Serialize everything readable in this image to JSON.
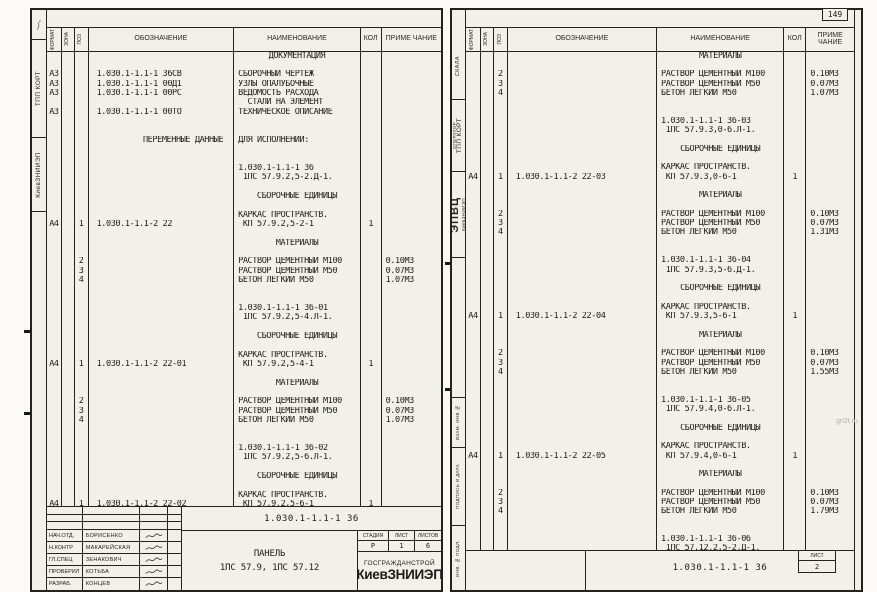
{
  "page_meta": {
    "page_number": "149",
    "watermark": "gn2t.ru"
  },
  "columns": {
    "format": "ФОРМАТ",
    "zone": "ЗОНА",
    "poz": "ПОЗ",
    "oboznachenie": "ОБОЗНАЧЕНИЕ",
    "naimenovanie": "НАИМЕНОВАНИЕ",
    "kol": "КОЛ",
    "primechanie": "ПРИМЕ ЧАНИЕ"
  },
  "left_page": {
    "margin": {
      "dept": "ТПП КОРТ",
      "org": "КиевЗНИИЭП"
    },
    "rows": [
      {
        "n": "ДОКУМЕНТАЦИЯ",
        "c": true
      },
      {},
      {
        "f": "А3",
        "o": "1.030.1-1.1-1 36СВ",
        "n": "СБОРОЧНЫЙ ЧЕРТЕЖ"
      },
      {
        "f": "А3",
        "o": "1.030.1-1.1-1 00Д1",
        "n": "УЗЛЫ ОПАЛУБОЧНЫЕ"
      },
      {
        "f": "А3",
        "o": "1.030.1-1.1-1 00РС",
        "n": "ВЕДОМОСТЬ РАСХОДА"
      },
      {
        "n": "  СТАЛИ НА ЭЛЕМЕНТ"
      },
      {
        "f": "А3",
        "o": "1.030.1-1.1-1 00ТО",
        "n": "ТЕХНИЧЕСКОЕ ОПИСАНИЕ"
      },
      {},
      {},
      {
        "o": "ПЕРЕМЕННЫЕ ДАННЫЕ",
        "or": true,
        "n": "ДЛЯ ИСПОЛНЕНИЙ:"
      },
      {},
      {},
      {
        "n": "1.030.1-1.1-1 36"
      },
      {
        "n": " 1ПС 57.9.2,5-2.Д-1."
      },
      {},
      {
        "n": "СБОРОЧНЫЕ ЕДИНИЦЫ",
        "c": true
      },
      {},
      {
        "n": "КАРКАС ПРОСТРАНСТВ."
      },
      {
        "f": "А4",
        "p": "1",
        "o": "1.030.1-1.1-2 22",
        "n": " КП 57.9.2,5-2-1",
        "k": "1"
      },
      {},
      {
        "n": "МАТЕРИАЛЫ",
        "c": true
      },
      {},
      {
        "p": "2",
        "n": "РАСТВОР ЦЕМЕНТНЫЙ М100",
        "pr": "0.10М3"
      },
      {
        "p": "3",
        "n": "РАСТВОР ЦЕМЕНТНЫЙ М50",
        "pr": "0.07М3"
      },
      {
        "p": "4",
        "n": "БЕТОН ЛЕГКИЙ М50",
        "pr": "1.07М3"
      },
      {},
      {},
      {
        "n": "1.030.1-1.1-1 36-01"
      },
      {
        "n": " 1ПС 57.9.2,5-4.Л-1."
      },
      {},
      {
        "n": "СБОРОЧНЫЕ ЕДИНИЦЫ",
        "c": true
      },
      {},
      {
        "n": "КАРКАС ПРОСТРАНСТВ."
      },
      {
        "f": "А4",
        "p": "1",
        "o": "1.030.1-1.1-2 22-01",
        "n": " КП 57.9.2,5-4-1",
        "k": "1"
      },
      {},
      {
        "n": "МАТЕРИАЛЫ",
        "c": true
      },
      {},
      {
        "p": "2",
        "n": "РАСТВОР ЦЕМЕНТНЫЙ М100",
        "pr": "0.10М3"
      },
      {
        "p": "3",
        "n": "РАСТВОР ЦЕМЕНТНЫЙ М50",
        "pr": "0.07М3"
      },
      {
        "p": "4",
        "n": "БЕТОН ЛЕГКИЙ М50",
        "pr": "1.07М3"
      },
      {},
      {},
      {
        "n": "1.030.1-1.1-1 36-02"
      },
      {
        "n": " 1ПС 57.9.2,5-6.Л-1."
      },
      {},
      {
        "n": "СБОРОЧНЫЕ ЕДИНИЦЫ",
        "c": true
      },
      {},
      {
        "n": "КАРКАС ПРОСТРАНСТВ."
      },
      {
        "f": "А4",
        "p": "1",
        "o": "1.030.1-1.1-2 22-02",
        "n": " КП 57.9.2,5-6-1",
        "k": "1"
      }
    ],
    "titleblock": {
      "designation": "1.030.1-1.1-1 36",
      "staff": [
        {
          "role": "НАЧ.ОТД.",
          "name": "БОРИСЕНКО"
        },
        {
          "role": "Н.КОНТР",
          "name": "МАКАРЕЙСКАЯ"
        },
        {
          "role": "ГЛ.СПЕЦ",
          "name": "ЗЕНАКОВИЧ"
        },
        {
          "role": "ПРОВЕРИЛ",
          "name": "КОТЬБА"
        },
        {
          "role": "РАЗРАБ.",
          "name": "КОНЦЕВ"
        }
      ],
      "title_line1": "ПАНЕЛЬ",
      "title_line2": "1ПС 57.9, 1ПС 57.12",
      "stage_label": "СТАДИЯ",
      "sheet_label": "ЛИСТ",
      "sheets_label": "ЛИСТОВ",
      "stage": "Р",
      "sheet": "1",
      "sheets": "6",
      "org_line1": "ГОСГРАЖДАНСТРОЙ",
      "org_line2": "КиевЗНИИЭП"
    }
  },
  "right_page": {
    "margin": {
      "name": "СКАЛА",
      "operator": "ОПЕРАТОР",
      "dept": "ТПП КОРТ",
      "org_big": "ЭПВЦ",
      "org_small": "КиевЗНИИЭП",
      "vzaim": "ВЗАМ. ИНВ №",
      "podpis": "ПОДПИСЬ И ДАТА",
      "inv": "ИНВ. № ПОДЛ."
    },
    "rows": [
      {
        "n": "МАТЕРИАЛЫ",
        "c": true
      },
      {},
      {
        "p": "2",
        "n": "РАСТВОР ЦЕМЕНТНЫЙ М100",
        "pr": "0.10М3"
      },
      {
        "p": "3",
        "n": "РАСТВОР ЦЕМЕНТНЫЙ М50",
        "pr": "0.07М3"
      },
      {
        "p": "4",
        "n": "БЕТОН ЛЕГКИЙ М50",
        "pr": "1.07М3"
      },
      {},
      {},
      {
        "n": "1.030.1-1.1-1 36-03"
      },
      {
        "n": " 1ПС 57.9.3,0-6.Л-1."
      },
      {},
      {
        "n": "СБОРОЧНЫЕ ЕДИНИЦЫ",
        "c": true
      },
      {},
      {
        "n": "КАРКАС ПРОСТРАНСТВ."
      },
      {
        "f": "А4",
        "p": "1",
        "o": "1.030.1-1.1-2 22-03",
        "n": " КП 57.9.3,0-6-1",
        "k": "1"
      },
      {},
      {
        "n": "МАТЕРИАЛЫ",
        "c": true
      },
      {},
      {
        "p": "2",
        "n": "РАСТВОР ЦЕМЕНТНЫЙ М100",
        "pr": "0.10М3"
      },
      {
        "p": "3",
        "n": "РАСТВОР ЦЕМЕНТНЫЙ М50",
        "pr": "0.07М3"
      },
      {
        "p": "4",
        "n": "БЕТОН ЛЕГКИЙ М50",
        "pr": "1.31М3"
      },
      {},
      {},
      {
        "n": "1.030.1-1.1-1 36-04"
      },
      {
        "n": " 1ПС 57.9.3,5-6.Д-1."
      },
      {},
      {
        "n": "СБОРОЧНЫЕ ЕДИНИЦЫ",
        "c": true
      },
      {},
      {
        "n": "КАРКАС ПРОСТРАНСТВ."
      },
      {
        "f": "А4",
        "p": "1",
        "o": "1.030.1-1.1-2 22-04",
        "n": " КП 57.9.3,5-6-1",
        "k": "1"
      },
      {},
      {
        "n": "МАТЕРИАЛЫ",
        "c": true
      },
      {},
      {
        "p": "2",
        "n": "РАСТВОР ЦЕМЕНТНЫЙ М100",
        "pr": "0.10М3"
      },
      {
        "p": "3",
        "n": "РАСТВОР ЦЕМЕНТНЫЙ М50",
        "pr": "0.07М3"
      },
      {
        "p": "4",
        "n": "БЕТОН ЛЕГКИЙ М50",
        "pr": "1.55М3"
      },
      {},
      {},
      {
        "n": "1.030.1-1.1-1 36-05"
      },
      {
        "n": " 1ПС 57.9.4,0-6.Л-1."
      },
      {},
      {
        "n": "СБОРОЧНЫЕ ЕДИНИЦЫ",
        "c": true
      },
      {},
      {
        "n": "КАРКАС ПРОСТРАНСТВ."
      },
      {
        "f": "А4",
        "p": "1",
        "o": "1.030.1-1.1-2 22-05",
        "n": " КП 57.9.4,0-6-1",
        "k": "1"
      },
      {},
      {
        "n": "МАТЕРИАЛЫ",
        "c": true
      },
      {},
      {
        "p": "2",
        "n": "РАСТВОР ЦЕМЕНТНЫЙ М100",
        "pr": "0.10М3"
      },
      {
        "p": "3",
        "n": "РАСТВОР ЦЕМЕНТНЫЙ М50",
        "pr": "0.07М3"
      },
      {
        "p": "4",
        "n": "БЕТОН ЛЕГКИЙ М50",
        "pr": "1.79М3"
      },
      {},
      {},
      {
        "n": "1.030.1-1.1-1 36-06"
      },
      {
        "n": " 1ПС 57.12.2,5-2.Д-1."
      }
    ],
    "footer": {
      "designation": "1.030.1-1.1-1 36",
      "sheet_label": "ЛИСТ",
      "sheet": "2"
    }
  }
}
